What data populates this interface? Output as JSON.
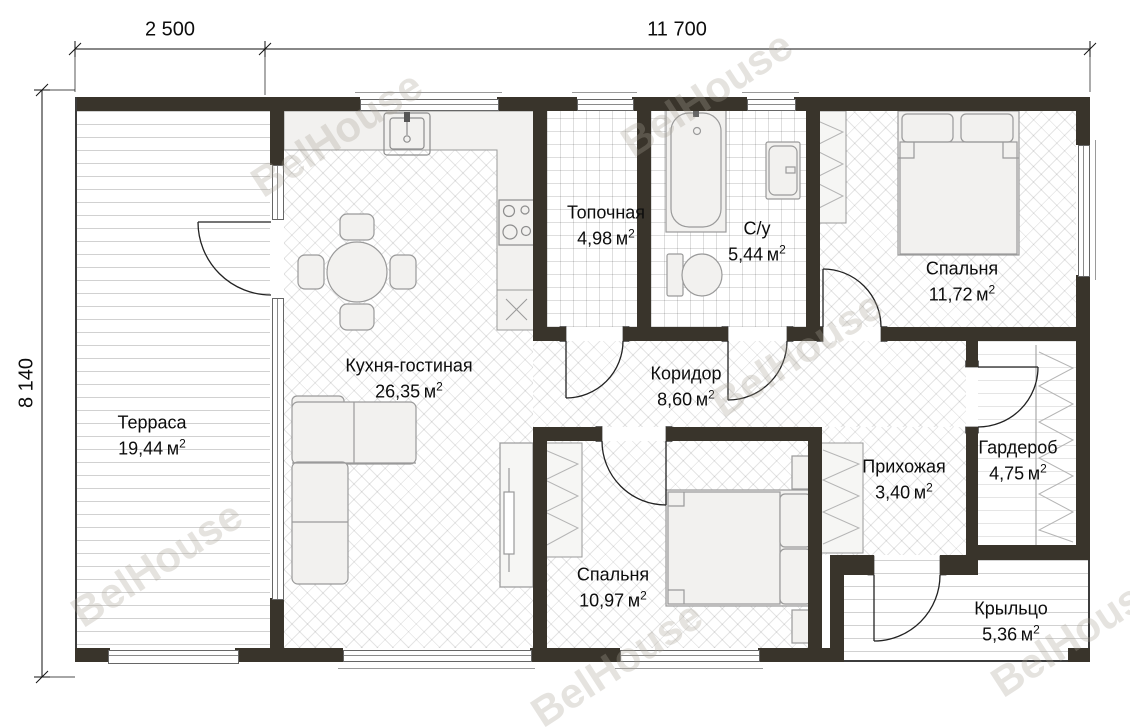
{
  "watermark": "BelHouse",
  "dimensions": {
    "top_left": "2 500",
    "top_right": "11 700",
    "left": "8 140"
  },
  "unit": "м",
  "sup": "2",
  "rooms": [
    {
      "name": "Терраса",
      "area": "19,44"
    },
    {
      "name": "Кухня-гостиная",
      "area": "26,35"
    },
    {
      "name": "Топочная",
      "area": "4,98"
    },
    {
      "name": "С/у",
      "area": "5,44"
    },
    {
      "name": "Спальня",
      "area": "11,72"
    },
    {
      "name": "Коридор",
      "area": "8,60"
    },
    {
      "name": "Прихожая",
      "area": "3,40"
    },
    {
      "name": "Гардероб",
      "area": "4,75"
    },
    {
      "name": "Спальня",
      "area": "10,97"
    },
    {
      "name": "Крыльцо",
      "area": "5,36"
    }
  ],
  "colors": {
    "wall": "#39342b",
    "dimension": "#111111",
    "furniture_fill": "#f2f1ef"
  }
}
